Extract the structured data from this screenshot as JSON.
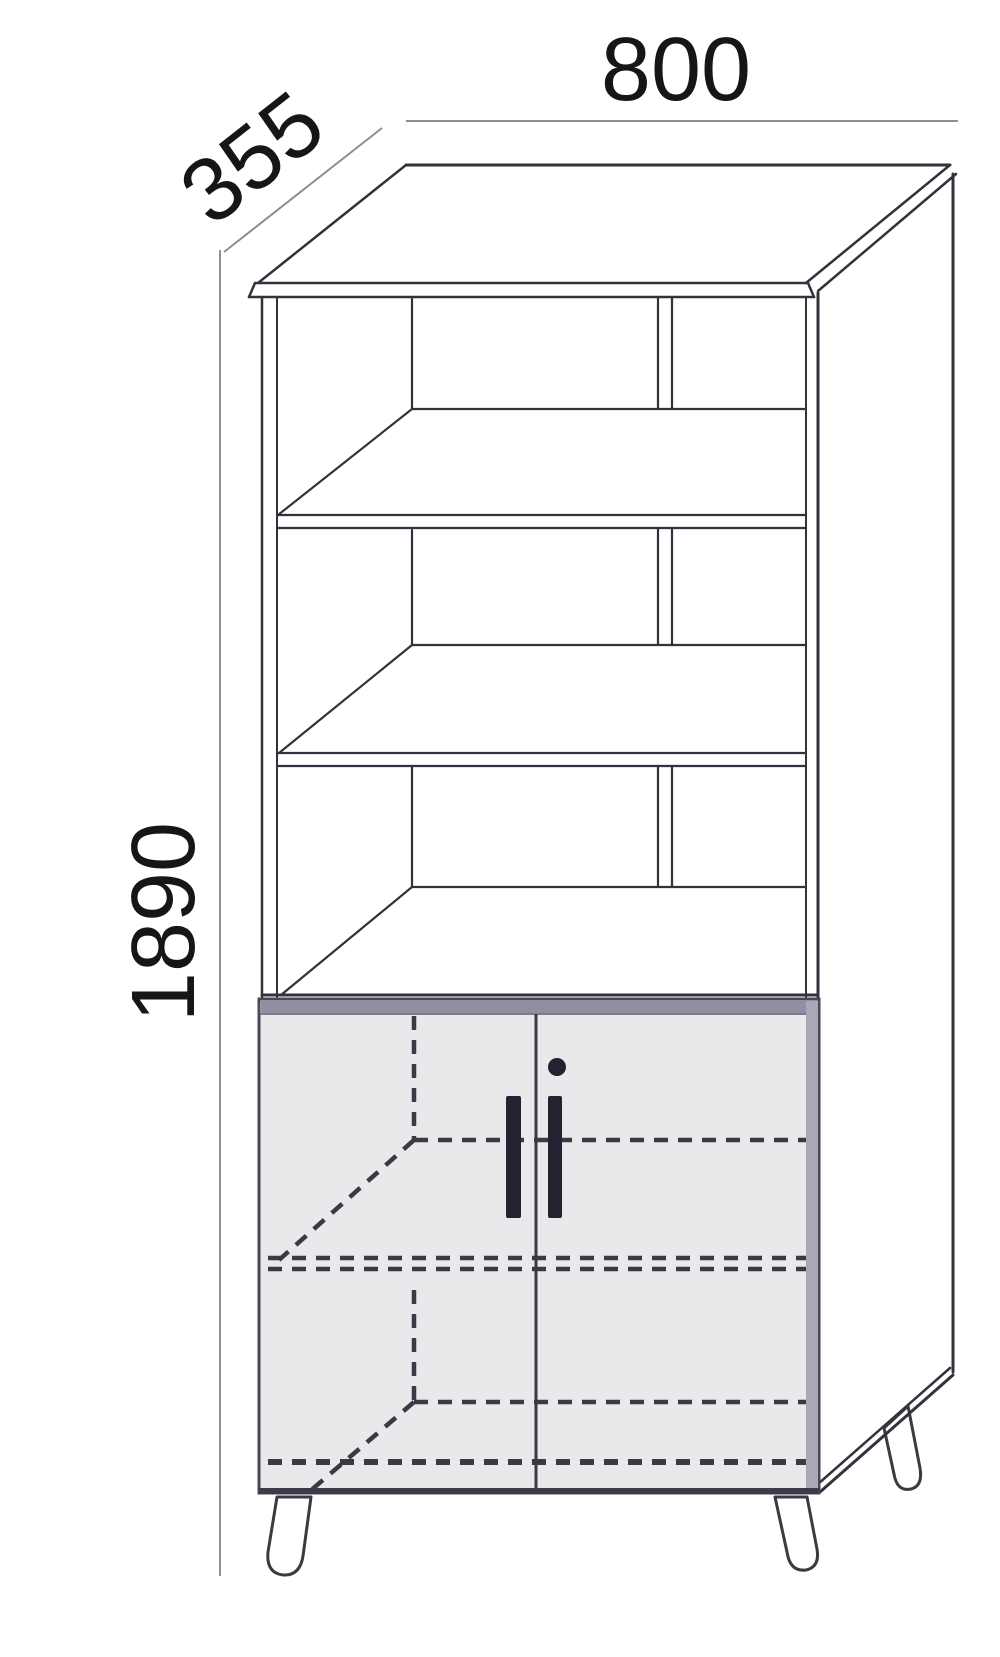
{
  "diagram": {
    "dimension_labels": {
      "width": "800",
      "depth": "355",
      "height": "1890"
    },
    "colors": {
      "background": "#ffffff",
      "structure_line": "#33323c",
      "dimension_line": "#8f8f8f",
      "label_text": "#161616",
      "door_fill": "#e9e8eb",
      "door_top_band": "#918ea2",
      "door_side_band": "#aaa7b6",
      "door_outline": "#4a4856",
      "handle": "#232230",
      "hidden_dashed_line": "#3a3946"
    },
    "parts": {
      "open_compartments": 3,
      "shelves": 2,
      "doors": 2,
      "door_handles": 2,
      "keyholes": 1,
      "legs_visible": 3
    }
  }
}
